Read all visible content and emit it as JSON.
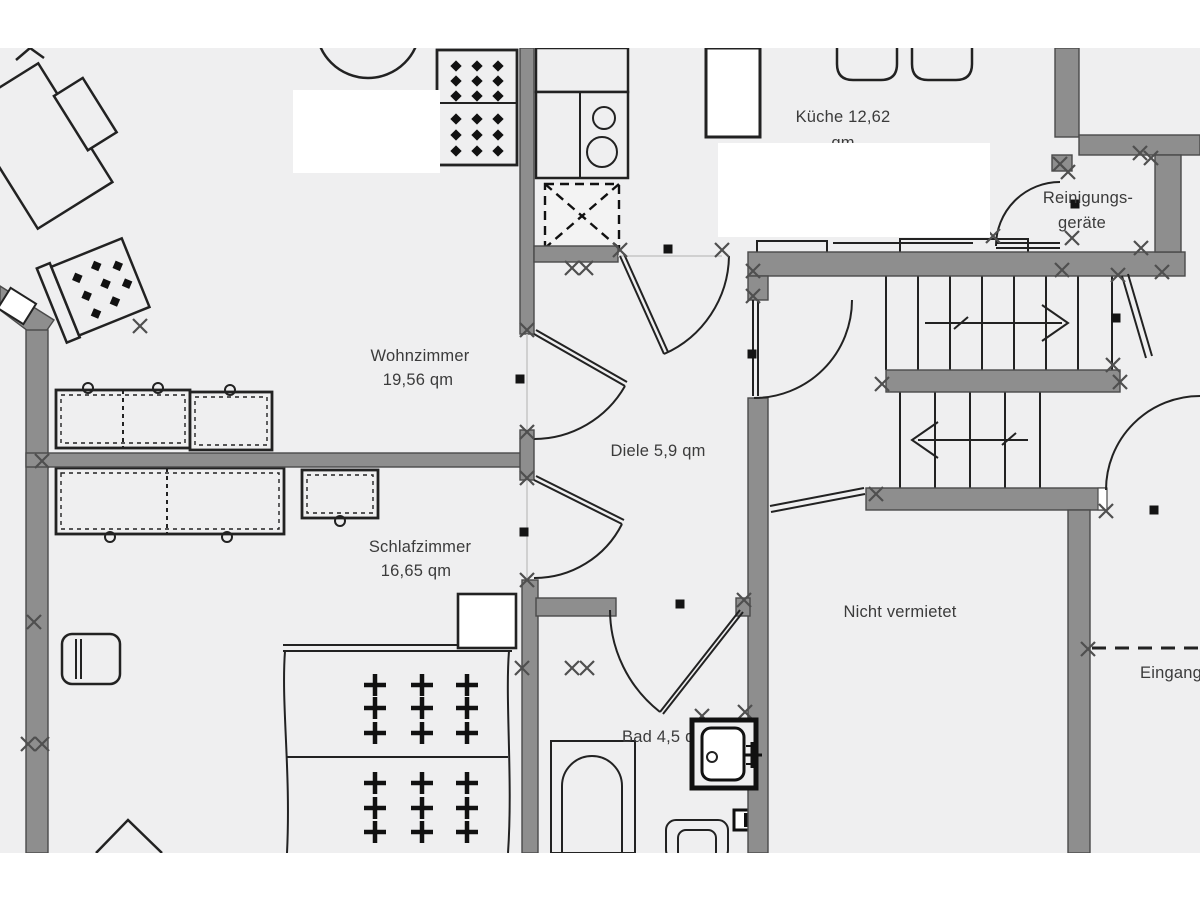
{
  "rooms": {
    "kueche": {
      "line1": "Küche 12,62",
      "line2": "qm"
    },
    "reinigungsgeraete": {
      "line1": "Reinigungs-",
      "line2": "geräte"
    },
    "wohnzimmer": {
      "line1": "Wohnzimmer",
      "line2": "19,56 qm"
    },
    "diele": {
      "label": "Diele 5,9 qm"
    },
    "schlafzimmer": {
      "line1": "Schlafzimmer",
      "line2": "16,65 qm"
    },
    "nicht_vermietet": {
      "label": "Nicht vermietet"
    },
    "bad": {
      "label": "Bad 4,5 qm"
    },
    "eingang": {
      "label": "Eingang"
    }
  },
  "colors": {
    "page_background": "#ffffff",
    "floor": "#efeff0",
    "wall": "#8e8e8e",
    "wall_outline": "#4a4a4a",
    "drawing_line": "#222222",
    "label_text": "#3b3b3b",
    "junction_marker": "#4f4f4f",
    "point_marker": "#141414"
  }
}
